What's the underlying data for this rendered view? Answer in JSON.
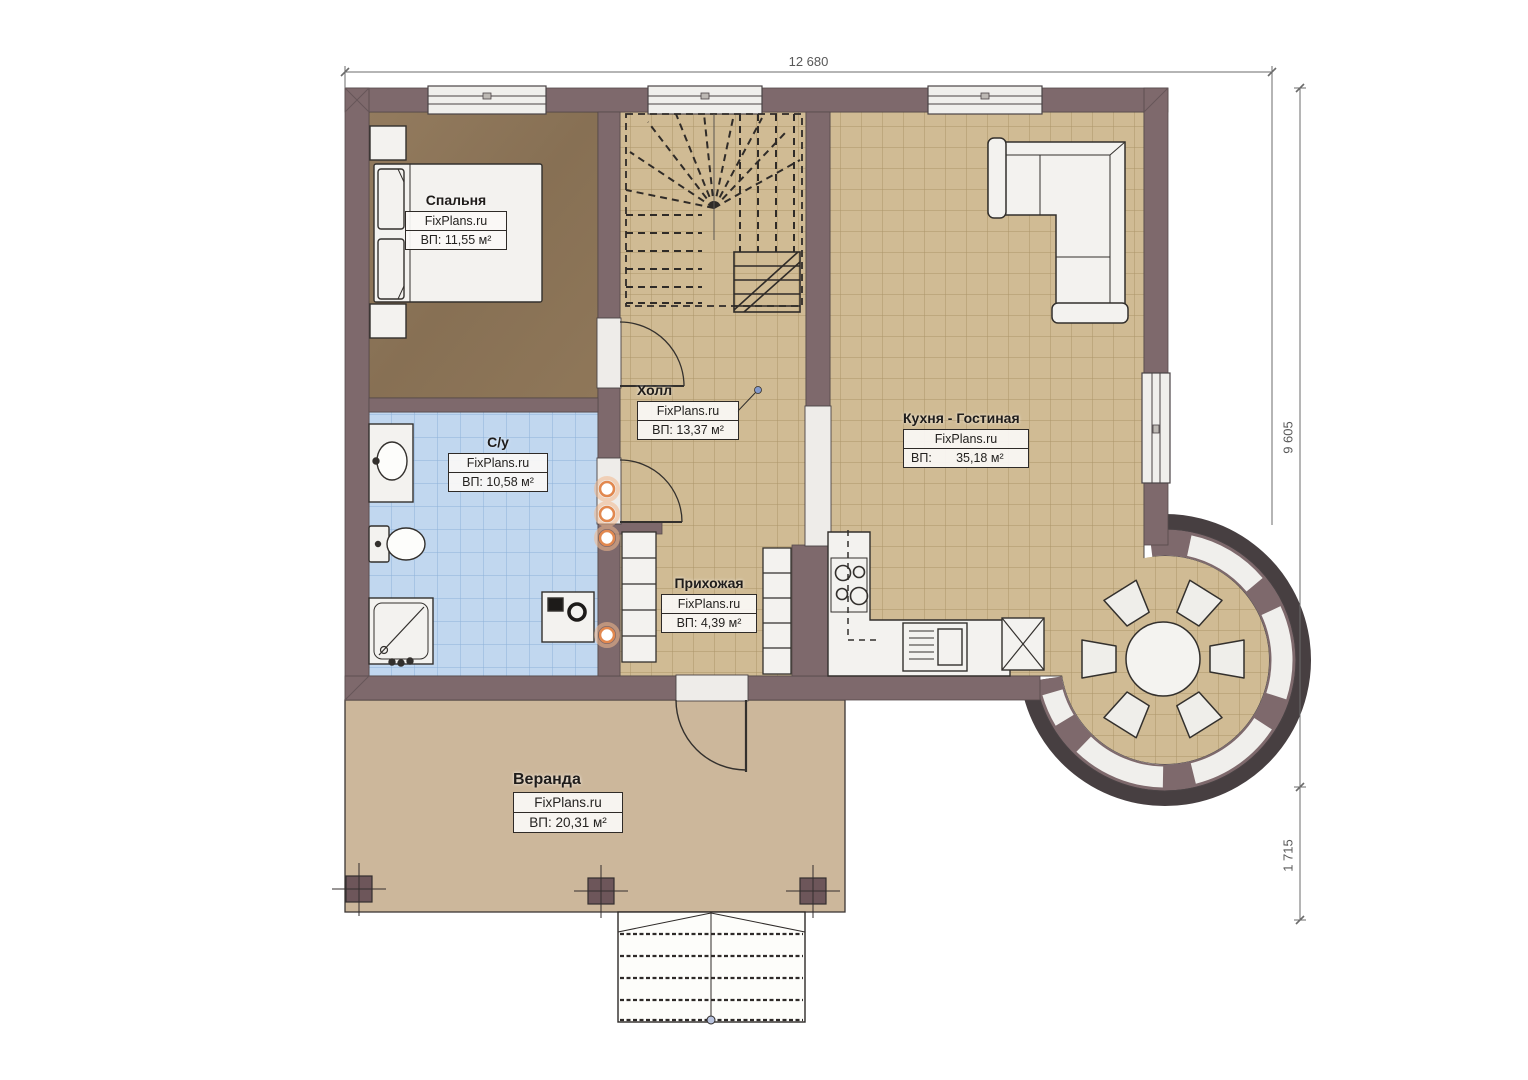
{
  "brand": "FixPlans.ru",
  "dimensions": {
    "width_total": "12 680",
    "height_main": "9 605",
    "height_veranda": "1 715"
  },
  "rooms": {
    "bedroom": {
      "name": "Спальня",
      "area": "ВП: 11,55 м²"
    },
    "bathroom": {
      "name": "С/у",
      "area": "ВП: 10,58 м²"
    },
    "hall": {
      "name": "Холл",
      "area": "ВП: 13,37 м²"
    },
    "kitchen": {
      "name": "Кухня - Гостиная",
      "area": "ВП:       35,18 м²"
    },
    "entry": {
      "name": "Прихожая",
      "area": "ВП: 4,39 м²"
    },
    "veranda": {
      "name": "Веранда",
      "area": "ВП: 20,31 м²"
    }
  },
  "colors": {
    "wall": "#7e696c",
    "floor_tile": "#d0bb94",
    "floor_bedroom": "#8d7557",
    "floor_bathroom": "#c1d7ef",
    "floor_veranda": "#ccb79b",
    "accent_orange": "#e2884f"
  }
}
